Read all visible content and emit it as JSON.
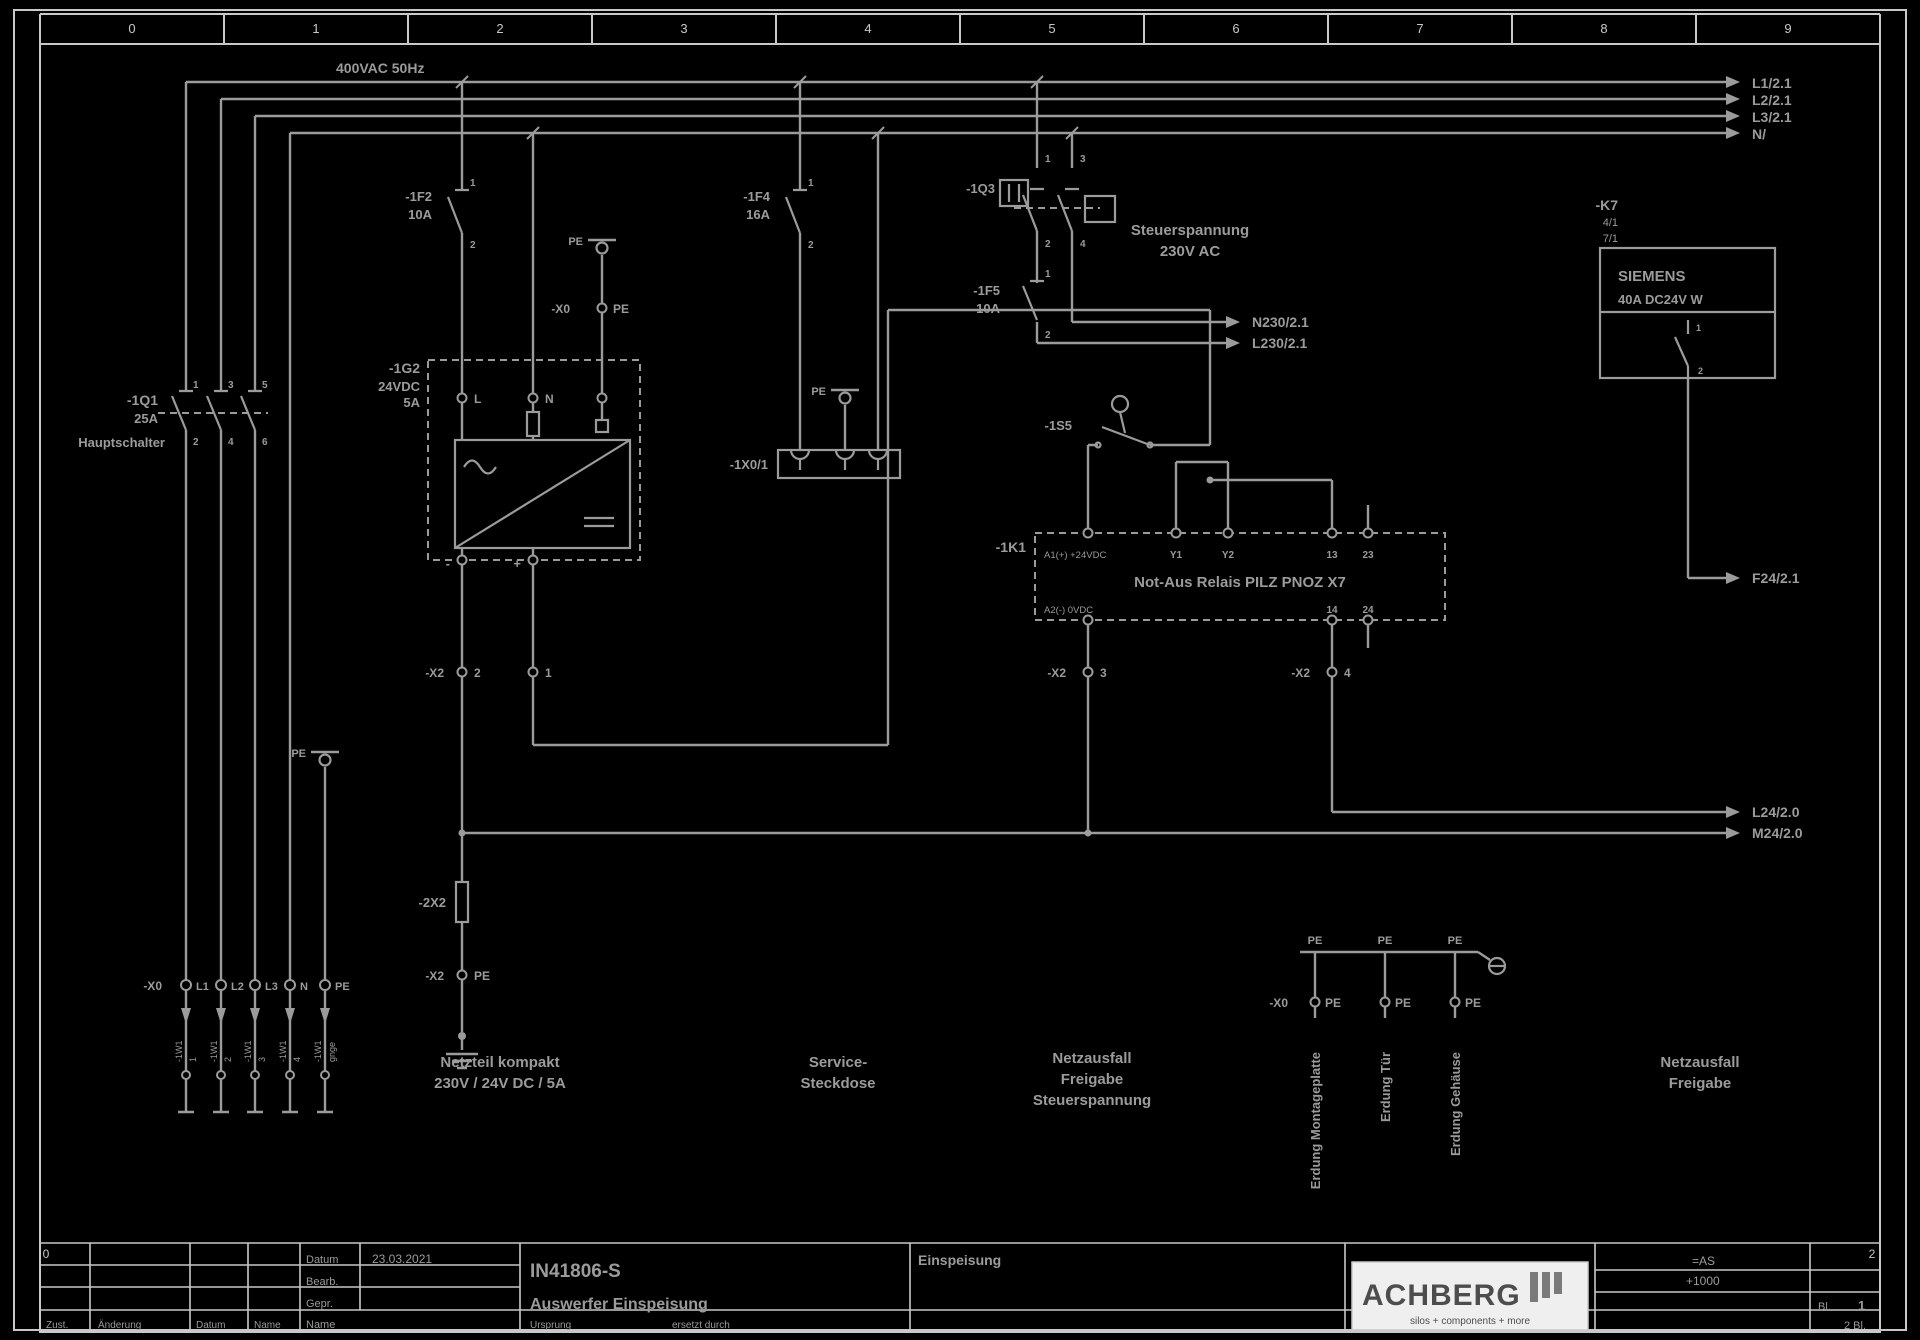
{
  "colors": {
    "line": "#9b9b9b",
    "frame": "#c8c8c8",
    "logo_bg": "#efefef",
    "logo_fg": "#4d4d4d"
  },
  "logo": {
    "name": "ACHBERG",
    "tagline": "silos + components + more"
  },
  "title_block": {
    "project_no": "IN41806-S",
    "description": "Auswerfer Einspeisung",
    "sheet_title": "Einspeisung",
    "date": "23.03.2021",
    "anlage": "=AS",
    "ort": "+1000",
    "sheet": "1",
    "total": "2 Bl."
  },
  "labels": [
    {
      "n": "ruler-col-0",
      "t": "0",
      "x": 132,
      "y": 33,
      "s": 13,
      "a": "m",
      "c": "frame"
    },
    {
      "n": "ruler-col-1",
      "t": "1",
      "x": 316,
      "y": 33,
      "s": 13,
      "a": "m",
      "c": "frame"
    },
    {
      "n": "ruler-col-2",
      "t": "2",
      "x": 500,
      "y": 33,
      "s": 13,
      "a": "m",
      "c": "frame"
    },
    {
      "n": "ruler-col-3",
      "t": "3",
      "x": 684,
      "y": 33,
      "s": 13,
      "a": "m",
      "c": "frame"
    },
    {
      "n": "ruler-col-4",
      "t": "4",
      "x": 868,
      "y": 33,
      "s": 13,
      "a": "m",
      "c": "frame"
    },
    {
      "n": "ruler-col-5",
      "t": "5",
      "x": 1052,
      "y": 33,
      "s": 13,
      "a": "m",
      "c": "frame"
    },
    {
      "n": "ruler-col-6",
      "t": "6",
      "x": 1236,
      "y": 33,
      "s": 13,
      "a": "m",
      "c": "frame"
    },
    {
      "n": "ruler-col-7",
      "t": "7",
      "x": 1420,
      "y": 33,
      "s": 13,
      "a": "m",
      "c": "frame"
    },
    {
      "n": "ruler-col-8",
      "t": "8",
      "x": 1604,
      "y": 33,
      "s": 13,
      "a": "m",
      "c": "frame"
    },
    {
      "n": "ruler-col-9",
      "t": "9",
      "x": 1788,
      "y": 33,
      "s": 13,
      "a": "m",
      "c": "frame"
    },
    {
      "n": "ruler-bottom-left",
      "t": "0",
      "x": 46,
      "y": 1258,
      "s": 12,
      "a": "m",
      "c": "frame"
    },
    {
      "n": "ruler-bottom-right",
      "t": "2",
      "x": 1872,
      "y": 1258,
      "s": 12,
      "a": "m",
      "c": "frame"
    },
    {
      "n": "mains-note",
      "t": "400VAC 50Hz",
      "x": 336,
      "y": 73,
      "s": 14,
      "b": true
    },
    {
      "n": "wire-ref-l1",
      "t": "L1/2.1",
      "x": 1752,
      "y": 88,
      "s": 14,
      "b": true
    },
    {
      "n": "wire-ref-l2",
      "t": "L2/2.1",
      "x": 1752,
      "y": 105,
      "s": 14,
      "b": true
    },
    {
      "n": "wire-ref-l3",
      "t": "L3/2.1",
      "x": 1752,
      "y": 122,
      "s": 14,
      "b": true
    },
    {
      "n": "wire-ref-n",
      "t": "N/",
      "x": 1752,
      "y": 139,
      "s": 14,
      "b": true
    },
    {
      "n": "q1-tag",
      "t": "-1Q1",
      "x": 158,
      "y": 405,
      "s": 14,
      "a": "e",
      "b": true
    },
    {
      "n": "q1-rating",
      "t": "25A",
      "x": 158,
      "y": 423,
      "s": 13,
      "a": "e",
      "b": true
    },
    {
      "n": "q1-function",
      "t": "Hauptschalter",
      "x": 165,
      "y": 447,
      "s": 13,
      "a": "e",
      "b": true
    },
    {
      "n": "q1-t1",
      "t": "1",
      "x": 193,
      "y": 388,
      "s": 10,
      "b": true
    },
    {
      "n": "q1-t3",
      "t": "3",
      "x": 228,
      "y": 388,
      "s": 10,
      "b": true
    },
    {
      "n": "q1-t5",
      "t": "5",
      "x": 262,
      "y": 388,
      "s": 10,
      "b": true
    },
    {
      "n": "q1-t2",
      "t": "2",
      "x": 193,
      "y": 445,
      "s": 10,
      "b": true
    },
    {
      "n": "q1-t4",
      "t": "4",
      "x": 228,
      "y": 445,
      "s": 10,
      "b": true
    },
    {
      "n": "q1-t6",
      "t": "6",
      "x": 262,
      "y": 445,
      "s": 10,
      "b": true
    },
    {
      "n": "f2-tag",
      "t": "-1F2",
      "x": 432,
      "y": 201,
      "s": 13,
      "a": "e",
      "b": true
    },
    {
      "n": "f2-rating",
      "t": "10A",
      "x": 432,
      "y": 219,
      "s": 13,
      "a": "e",
      "b": true
    },
    {
      "n": "f2-t1",
      "t": "1",
      "x": 470,
      "y": 186,
      "s": 10,
      "b": true
    },
    {
      "n": "f2-t2",
      "t": "2",
      "x": 470,
      "y": 248,
      "s": 10,
      "b": true
    },
    {
      "n": "f4-tag",
      "t": "-1F4",
      "x": 770,
      "y": 201,
      "s": 13,
      "a": "e",
      "b": true
    },
    {
      "n": "f4-rating",
      "t": "16A",
      "x": 770,
      "y": 219,
      "s": 13,
      "a": "e",
      "b": true
    },
    {
      "n": "f4-t1",
      "t": "1",
      "x": 808,
      "y": 186,
      "s": 10,
      "b": true
    },
    {
      "n": "f4-t2",
      "t": "2",
      "x": 808,
      "y": 248,
      "s": 10,
      "b": true
    },
    {
      "n": "socket-tag",
      "t": "-1X0/1",
      "x": 768,
      "y": 469,
      "s": 13,
      "a": "e",
      "b": true
    },
    {
      "n": "pe-label-left",
      "t": "PE",
      "x": 306,
      "y": 757,
      "s": 11,
      "a": "e",
      "b": true
    },
    {
      "n": "pe-label-socket",
      "t": "PE",
      "x": 826,
      "y": 395,
      "s": 11,
      "a": "e",
      "b": true
    },
    {
      "n": "pe-label-g2",
      "t": "PE",
      "x": 583,
      "y": 245,
      "s": 11,
      "a": "e",
      "b": true
    },
    {
      "n": "x0pe-tag",
      "t": "-X0",
      "x": 570,
      "y": 313,
      "s": 12,
      "a": "e",
      "b": true
    },
    {
      "n": "x0pe-term",
      "t": "PE",
      "x": 613,
      "y": 313,
      "s": 12,
      "b": true
    },
    {
      "n": "q3-tag",
      "t": "-1Q3",
      "x": 995,
      "y": 193,
      "s": 13,
      "a": "e",
      "b": true
    },
    {
      "n": "q3-t1",
      "t": "1",
      "x": 1045,
      "y": 162,
      "s": 10,
      "b": true
    },
    {
      "n": "q3-t3",
      "t": "3",
      "x": 1080,
      "y": 162,
      "s": 10,
      "b": true
    },
    {
      "n": "q3-t2",
      "t": "2",
      "x": 1045,
      "y": 247,
      "s": 10,
      "b": true
    },
    {
      "n": "q3-t4",
      "t": "4",
      "x": 1080,
      "y": 247,
      "s": 10,
      "b": true
    },
    {
      "n": "control-voltage-1",
      "t": "Steuerspannung",
      "x": 1190,
      "y": 235,
      "s": 15,
      "a": "m",
      "b": true
    },
    {
      "n": "control-voltage-2",
      "t": "230V AC",
      "x": 1190,
      "y": 256,
      "s": 15,
      "a": "m",
      "b": true
    },
    {
      "n": "f5-tag",
      "t": "-1F5",
      "x": 1000,
      "y": 295,
      "s": 13,
      "a": "e",
      "b": true
    },
    {
      "n": "f5-rating",
      "t": "10A",
      "x": 1000,
      "y": 313,
      "s": 13,
      "a": "e",
      "b": true
    },
    {
      "n": "f5-t1",
      "t": "1",
      "x": 1045,
      "y": 277,
      "s": 10,
      "b": true
    },
    {
      "n": "f5-t2",
      "t": "2",
      "x": 1045,
      "y": 338,
      "s": 10,
      "b": true
    },
    {
      "n": "wire-ref-n230",
      "t": "N230/2.1",
      "x": 1252,
      "y": 327,
      "s": 14,
      "b": true
    },
    {
      "n": "wire-ref-l230",
      "t": "L230/2.1",
      "x": 1252,
      "y": 348,
      "s": 14,
      "b": true
    },
    {
      "n": "g2-tag",
      "t": "-1G2",
      "x": 420,
      "y": 373,
      "s": 14,
      "a": "e",
      "b": true
    },
    {
      "n": "g2-rating1",
      "t": "24VDC",
      "x": 420,
      "y": 391,
      "s": 13,
      "a": "e",
      "b": true
    },
    {
      "n": "g2-rating2",
      "t": "5A",
      "x": 420,
      "y": 407,
      "s": 13,
      "a": "e",
      "b": true
    },
    {
      "n": "g2-term-l",
      "t": "L",
      "x": 474,
      "y": 403,
      "s": 12,
      "b": true
    },
    {
      "n": "g2-term-n",
      "t": "N",
      "x": 545,
      "y": 403,
      "s": 12,
      "b": true
    },
    {
      "n": "g2-out-minus",
      "t": "-",
      "x": 450,
      "y": 568,
      "s": 13,
      "a": "e",
      "b": true
    },
    {
      "n": "g2-out-plus",
      "t": "+",
      "x": 521,
      "y": 568,
      "s": 13,
      "a": "e",
      "b": true
    },
    {
      "n": "x2-tag-a",
      "t": "-X2",
      "x": 444,
      "y": 677,
      "s": 12,
      "a": "e",
      "b": true
    },
    {
      "n": "x2-term-2",
      "t": "2",
      "x": 474,
      "y": 677,
      "s": 12,
      "b": true
    },
    {
      "n": "x2-term-1",
      "t": "1",
      "x": 545,
      "y": 677,
      "s": 12,
      "b": true
    },
    {
      "n": "x2-tag-b",
      "t": "-X2",
      "x": 1066,
      "y": 677,
      "s": 12,
      "a": "e",
      "b": true
    },
    {
      "n": "x2-term-3",
      "t": "3",
      "x": 1100,
      "y": 677,
      "s": 12,
      "b": true
    },
    {
      "n": "x2-tag-c",
      "t": "-X2",
      "x": 1310,
      "y": 677,
      "s": 12,
      "a": "e",
      "b": true
    },
    {
      "n": "x2-term-4",
      "t": "4",
      "x": 1344,
      "y": 677,
      "s": 12,
      "b": true
    },
    {
      "n": "x2x-tag",
      "t": "-2X2",
      "x": 446,
      "y": 907,
      "s": 13,
      "a": "e",
      "b": true
    },
    {
      "n": "x2pe-tag",
      "t": "-X2",
      "x": 444,
      "y": 980,
      "s": 12,
      "a": "e",
      "b": true
    },
    {
      "n": "x2pe-term",
      "t": "PE",
      "x": 474,
      "y": 980,
      "s": 12,
      "b": true
    },
    {
      "n": "x0-tag",
      "t": "-X0",
      "x": 162,
      "y": 990,
      "s": 12,
      "a": "e",
      "b": true
    },
    {
      "n": "x0-term-l1",
      "t": "L1",
      "x": 196,
      "y": 990,
      "s": 11,
      "b": true
    },
    {
      "n": "x0-term-l2",
      "t": "L2",
      "x": 231,
      "y": 990,
      "s": 11,
      "b": true
    },
    {
      "n": "x0-term-l3",
      "t": "L3",
      "x": 265,
      "y": 990,
      "s": 11,
      "b": true
    },
    {
      "n": "x0-term-n",
      "t": "N",
      "x": 300,
      "y": 990,
      "s": 11,
      "b": true
    },
    {
      "n": "x0-term-pe",
      "t": "PE",
      "x": 335,
      "y": 990,
      "s": 11,
      "b": true
    },
    {
      "n": "cable-name-1",
      "t": "-1W1",
      "x": 182,
      "y": 1062,
      "s": 9,
      "r": -90
    },
    {
      "n": "cable-core-1",
      "t": "1",
      "x": 196,
      "y": 1062,
      "s": 9,
      "r": -90
    },
    {
      "n": "cable-name-2",
      "t": "-1W1",
      "x": 217,
      "y": 1062,
      "s": 9,
      "r": -90
    },
    {
      "n": "cable-core-2",
      "t": "2",
      "x": 231,
      "y": 1062,
      "s": 9,
      "r": -90
    },
    {
      "n": "cable-name-3",
      "t": "-1W1",
      "x": 251,
      "y": 1062,
      "s": 9,
      "r": -90
    },
    {
      "n": "cable-core-3",
      "t": "3",
      "x": 265,
      "y": 1062,
      "s": 9,
      "r": -90
    },
    {
      "n": "cable-name-4",
      "t": "-1W1",
      "x": 286,
      "y": 1062,
      "s": 9,
      "r": -90
    },
    {
      "n": "cable-core-4",
      "t": "4",
      "x": 300,
      "y": 1062,
      "s": 9,
      "r": -90
    },
    {
      "n": "cable-name-5",
      "t": "-1W1",
      "x": 321,
      "y": 1062,
      "s": 9,
      "r": -90
    },
    {
      "n": "cable-core-5",
      "t": "gnge",
      "x": 335,
      "y": 1062,
      "s": 9,
      "r": -90
    },
    {
      "n": "k1-tag",
      "t": "-1K1",
      "x": 1026,
      "y": 552,
      "s": 14,
      "a": "e",
      "b": true
    },
    {
      "n": "k1-a1",
      "t": "A1(+) +24VDC",
      "x": 1044,
      "y": 558,
      "s": 9.5
    },
    {
      "n": "k1-y1",
      "t": "Y1",
      "x": 1176,
      "y": 558,
      "s": 10,
      "a": "m",
      "b": true
    },
    {
      "n": "k1-y2",
      "t": "Y2",
      "x": 1228,
      "y": 558,
      "s": 10,
      "a": "m",
      "b": true
    },
    {
      "n": "k1-13",
      "t": "13",
      "x": 1332,
      "y": 558,
      "s": 10,
      "a": "m",
      "b": true
    },
    {
      "n": "k1-23",
      "t": "23",
      "x": 1368,
      "y": 558,
      "s": 10,
      "a": "m",
      "b": true
    },
    {
      "n": "k1-title",
      "t": "Not-Aus Relais PILZ PNOZ X7",
      "x": 1240,
      "y": 587,
      "s": 15,
      "a": "m",
      "b": true
    },
    {
      "n": "k1-a2",
      "t": "A2(-) 0VDC",
      "x": 1044,
      "y": 613,
      "s": 9.5
    },
    {
      "n": "k1-14",
      "t": "14",
      "x": 1332,
      "y": 613,
      "s": 10,
      "a": "m",
      "b": true
    },
    {
      "n": "k1-24",
      "t": "24",
      "x": 1368,
      "y": 613,
      "s": 10,
      "a": "m",
      "b": true
    },
    {
      "n": "s5-tag",
      "t": "-1S5",
      "x": 1072,
      "y": 430,
      "s": 13,
      "a": "e",
      "b": true
    },
    {
      "n": "k7-tag",
      "t": "-K7",
      "x": 1618,
      "y": 210,
      "s": 14,
      "a": "e",
      "b": true
    },
    {
      "n": "k7-ref1",
      "t": "4/1",
      "x": 1618,
      "y": 226,
      "s": 11,
      "a": "e"
    },
    {
      "n": "k7-ref2",
      "t": "7/1",
      "x": 1618,
      "y": 242,
      "s": 11,
      "a": "e"
    },
    {
      "n": "k7-brand",
      "t": "SIEMENS",
      "x": 1618,
      "y": 281,
      "s": 15,
      "b": true
    },
    {
      "n": "k7-rating",
      "t": "40A DC24V W",
      "x": 1618,
      "y": 304,
      "s": 13,
      "b": true
    },
    {
      "n": "k7-t1",
      "t": "1",
      "x": 1696,
      "y": 331,
      "s": 9,
      "b": true
    },
    {
      "n": "k7-t2",
      "t": "2",
      "x": 1698,
      "y": 374,
      "s": 9,
      "b": true
    },
    {
      "n": "wire-ref-f24",
      "t": "F24/2.1",
      "x": 1752,
      "y": 583,
      "s": 14,
      "b": true
    },
    {
      "n": "wire-ref-l24",
      "t": "L24/2.0",
      "x": 1752,
      "y": 817,
      "s": 14,
      "b": true
    },
    {
      "n": "wire-ref-m24",
      "t": "M24/2.0",
      "x": 1752,
      "y": 838,
      "s": 14,
      "b": true
    },
    {
      "n": "caption-psu-1",
      "t": "Netzteil kompakt",
      "x": 500,
      "y": 1067,
      "s": 15,
      "a": "m",
      "b": true
    },
    {
      "n": "caption-psu-2",
      "t": "230V / 24V DC / 5A",
      "x": 500,
      "y": 1088,
      "s": 15,
      "a": "m",
      "b": true
    },
    {
      "n": "caption-socket-1",
      "t": "Service-",
      "x": 838,
      "y": 1067,
      "s": 15,
      "a": "m",
      "b": true
    },
    {
      "n": "caption-socket-2",
      "t": "Steckdose",
      "x": 838,
      "y": 1088,
      "s": 15,
      "a": "m",
      "b": true
    },
    {
      "n": "caption-relay-1",
      "t": "Netzausfall",
      "x": 1092,
      "y": 1063,
      "s": 15,
      "a": "m",
      "b": true
    },
    {
      "n": "caption-relay-2",
      "t": "Freigabe",
      "x": 1092,
      "y": 1084,
      "s": 15,
      "a": "m",
      "b": true
    },
    {
      "n": "caption-relay-3",
      "t": "Steuerspannung",
      "x": 1092,
      "y": 1105,
      "s": 15,
      "a": "m",
      "b": true
    },
    {
      "n": "caption-k7-1",
      "t": "Netzausfall",
      "x": 1700,
      "y": 1067,
      "s": 15,
      "a": "m",
      "b": true
    },
    {
      "n": "caption-k7-2",
      "t": "Freigabe",
      "x": 1700,
      "y": 1088,
      "s": 15,
      "a": "m",
      "b": true
    },
    {
      "n": "caption-earth-1",
      "t": "Erdung Montageplatte",
      "x": 1320,
      "y": 1052,
      "s": 13,
      "a": "e",
      "b": true,
      "r": -90
    },
    {
      "n": "caption-earth-2",
      "t": "Erdung Tür",
      "x": 1390,
      "y": 1052,
      "s": 13,
      "a": "e",
      "b": true,
      "r": -90
    },
    {
      "n": "caption-earth-3",
      "t": "Erdung Gehäuse",
      "x": 1460,
      "y": 1052,
      "s": 13,
      "a": "e",
      "b": true,
      "r": -90
    },
    {
      "n": "pe-top-1",
      "t": "PE",
      "x": 1315,
      "y": 944,
      "s": 11,
      "a": "m",
      "b": true
    },
    {
      "n": "pe-top-2",
      "t": "PE",
      "x": 1385,
      "y": 944,
      "s": 11,
      "a": "m",
      "b": true
    },
    {
      "n": "pe-top-3",
      "t": "PE",
      "x": 1455,
      "y": 944,
      "s": 11,
      "a": "m",
      "b": true
    },
    {
      "n": "rpe-x0-tag",
      "t": "-X0",
      "x": 1288,
      "y": 1007,
      "s": 12,
      "a": "e",
      "b": true
    },
    {
      "n": "rpe-term-1",
      "t": "PE",
      "x": 1325,
      "y": 1007,
      "s": 12,
      "b": true
    },
    {
      "n": "rpe-term-2",
      "t": "PE",
      "x": 1395,
      "y": 1007,
      "s": 12,
      "b": true
    },
    {
      "n": "rpe-term-3",
      "t": "PE",
      "x": 1465,
      "y": 1007,
      "s": 12,
      "b": true
    },
    {
      "n": "tb-datum-label",
      "t": "Datum",
      "x": 306,
      "y": 1263,
      "s": 11
    },
    {
      "n": "tb-datum-value",
      "t": "23.03.2021",
      "x": 372,
      "y": 1263,
      "s": 12
    },
    {
      "n": "tb-bearb-label",
      "t": "Bearb.",
      "x": 306,
      "y": 1285,
      "s": 11
    },
    {
      "n": "tb-gepr-label",
      "t": "Gepr.",
      "x": 306,
      "y": 1307,
      "s": 11
    },
    {
      "n": "tb-name-label",
      "t": "Name",
      "x": 306,
      "y": 1328,
      "s": 11
    },
    {
      "n": "tb-zust-label",
      "t": "Zust.",
      "x": 46,
      "y": 1328,
      "s": 10
    },
    {
      "n": "tb-aenderung-label",
      "t": "Änderung",
      "x": 98,
      "y": 1328,
      "s": 10
    },
    {
      "n": "tb-datum2-label",
      "t": "Datum",
      "x": 196,
      "y": 1328,
      "s": 10
    },
    {
      "n": "tb-name2-label",
      "t": "Name",
      "x": 254,
      "y": 1328,
      "s": 10
    },
    {
      "n": "tb-project-no",
      "t": "IN41806-S",
      "x": 530,
      "y": 1277,
      "s": 19,
      "b": true
    },
    {
      "n": "tb-description",
      "t": "Auswerfer Einspeisung",
      "x": 530,
      "y": 1309,
      "s": 16,
      "b": true
    },
    {
      "n": "tb-ursprung",
      "t": "Ursprung",
      "x": 530,
      "y": 1328,
      "s": 10
    },
    {
      "n": "tb-ersetzt",
      "t": "ersetzt durch",
      "x": 672,
      "y": 1328,
      "s": 10
    },
    {
      "n": "tb-sheet-title",
      "t": "Einspeisung",
      "x": 918,
      "y": 1265,
      "s": 14,
      "b": true
    },
    {
      "n": "tb-anlage",
      "t": "=AS",
      "x": 1692,
      "y": 1265,
      "s": 12
    },
    {
      "n": "tb-ort",
      "t": "+1000",
      "x": 1686,
      "y": 1285,
      "s": 12
    },
    {
      "n": "tb-blatt-label",
      "t": "Bl.",
      "x": 1818,
      "y": 1310,
      "s": 11
    },
    {
      "n": "tb-blatt-no",
      "t": "1",
      "x": 1858,
      "y": 1310,
      "s": 13,
      "b": true
    },
    {
      "n": "tb-blatt-total",
      "t": "2 Bl.",
      "x": 1844,
      "y": 1329,
      "s": 11
    }
  ]
}
